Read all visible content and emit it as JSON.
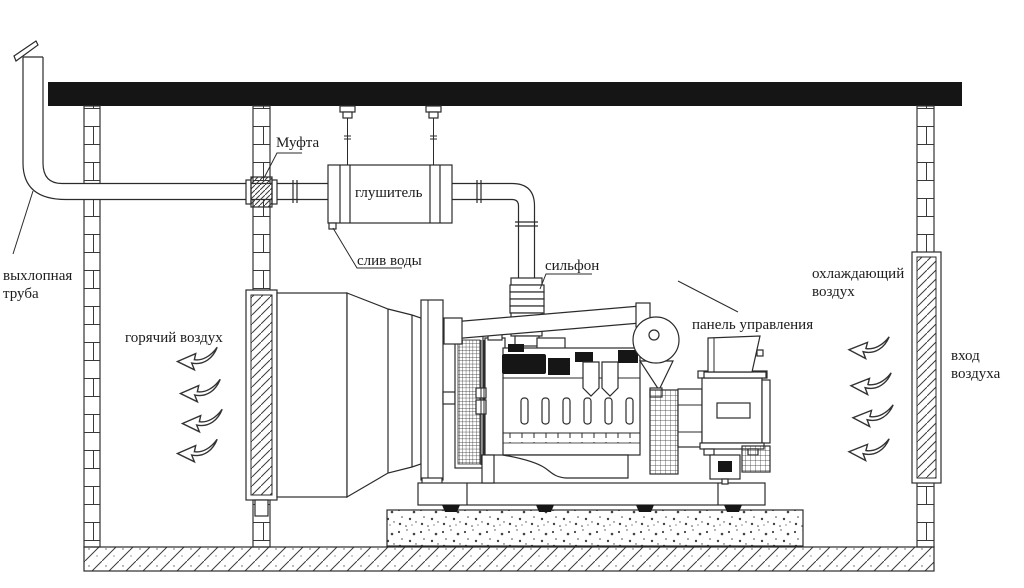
{
  "labels": {
    "exhaust_pipe_line1": "выхлопная",
    "exhaust_pipe_line2": "труба",
    "coupling": "Муфта",
    "muffler": "глушитель",
    "water_drain": "слив воды",
    "bellows": "сильфон",
    "control_panel": "панель управления",
    "hot_air": "горячий воздух",
    "cooling_air_line1": "охлаждающий",
    "cooling_air_line2": "воздух",
    "air_inlet_line1": "вход",
    "air_inlet_line2": "воздуха"
  },
  "icons": {
    "airflow": "wavy-left-arrow"
  },
  "colors": {
    "line": "#2b2b2b",
    "roof": "#151515",
    "background": "#ffffff"
  }
}
